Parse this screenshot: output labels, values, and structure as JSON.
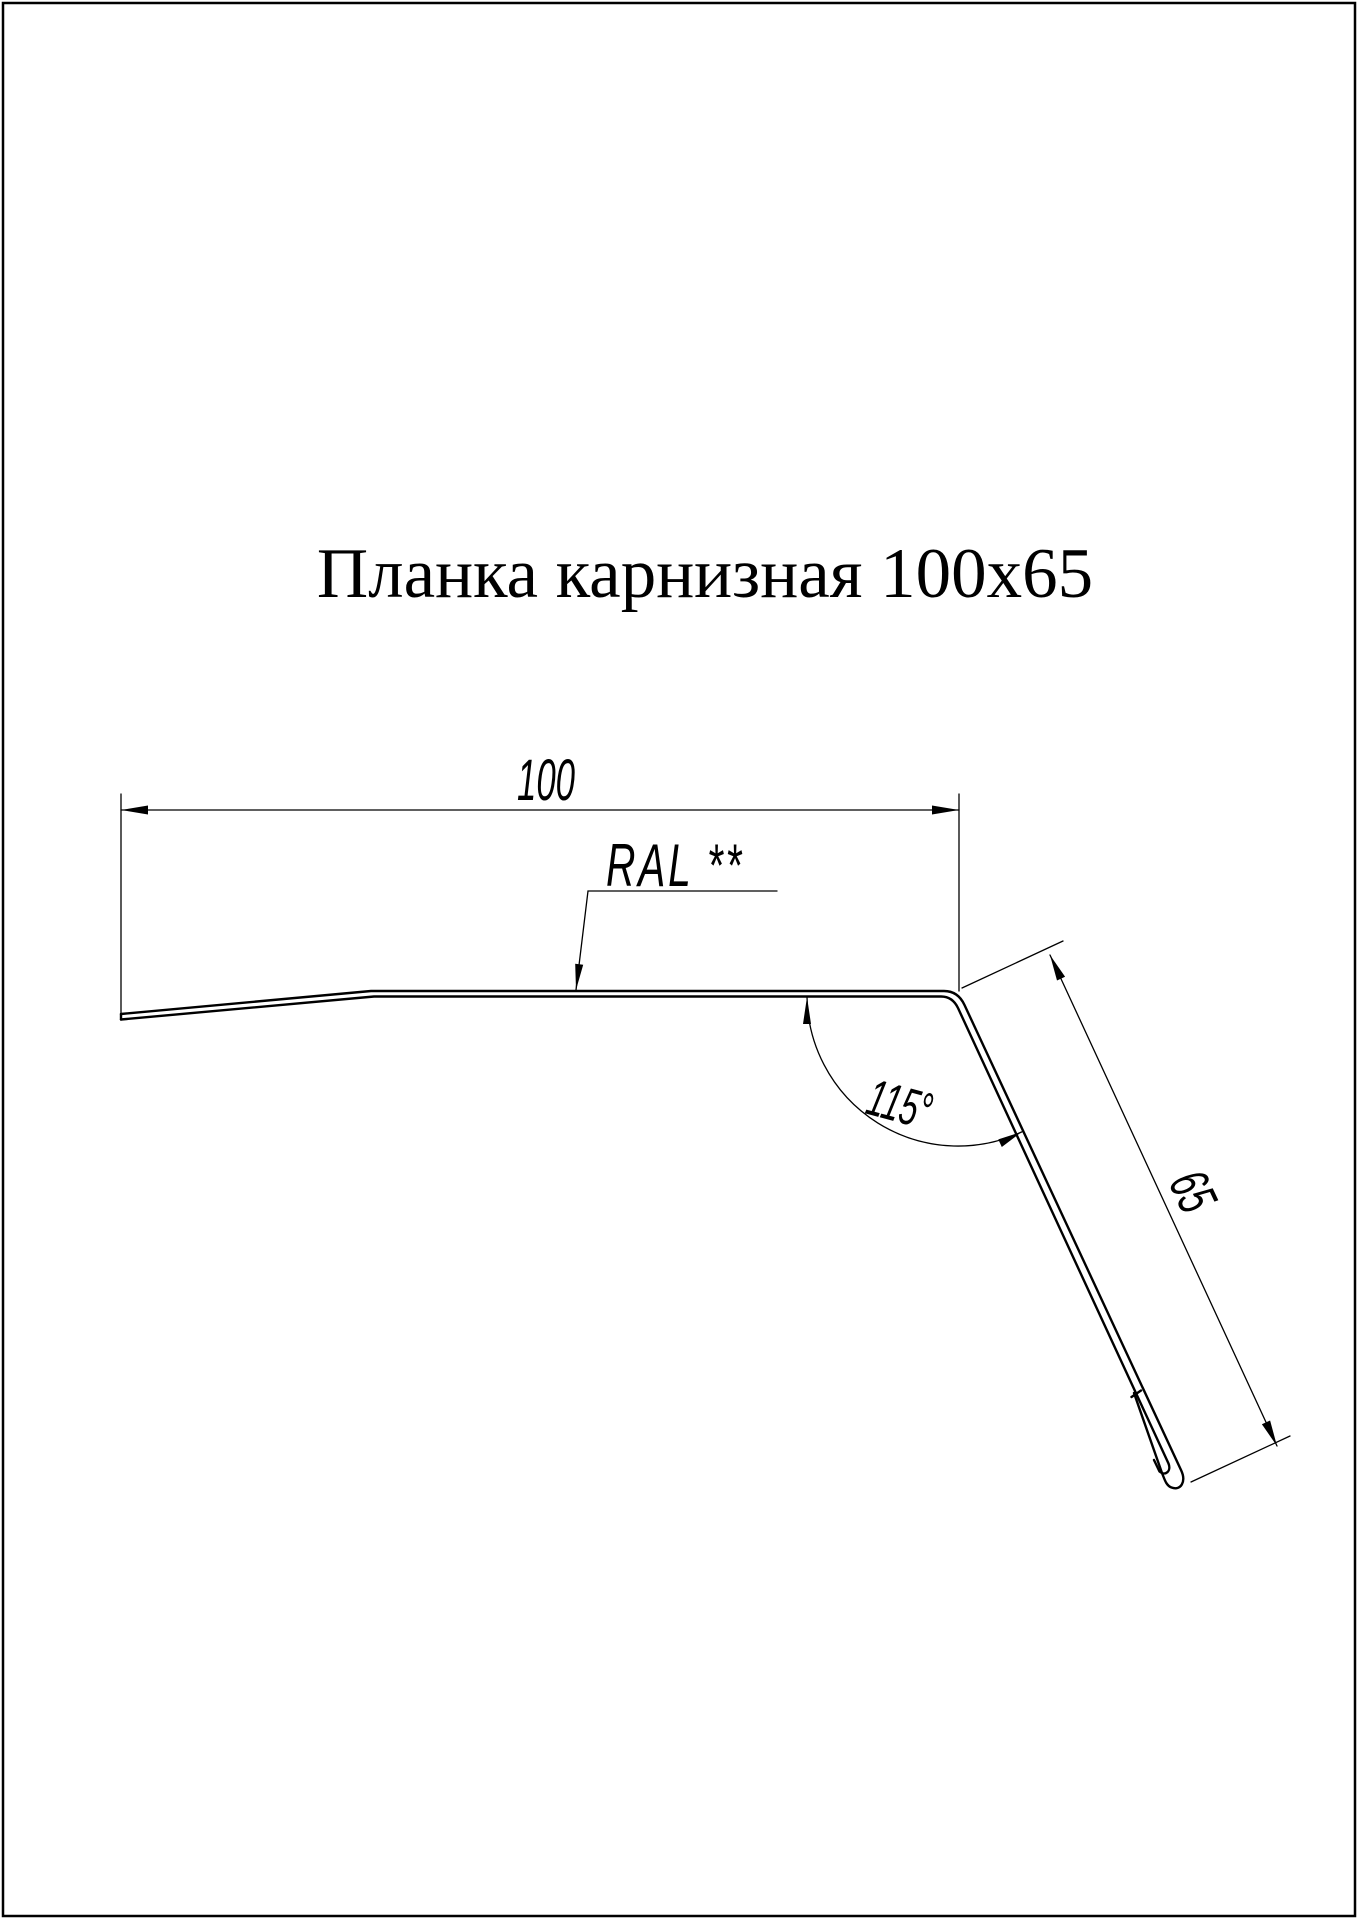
{
  "page": {
    "title": "Планка карнизная 100x65"
  },
  "drawing": {
    "name": "eaves-strip-profile",
    "width_label": "100",
    "flange_label": "65",
    "angle_label": "115°",
    "coating_label": "RAL **"
  },
  "colors": {
    "ink": "#000000",
    "paper": "#ffffff"
  }
}
